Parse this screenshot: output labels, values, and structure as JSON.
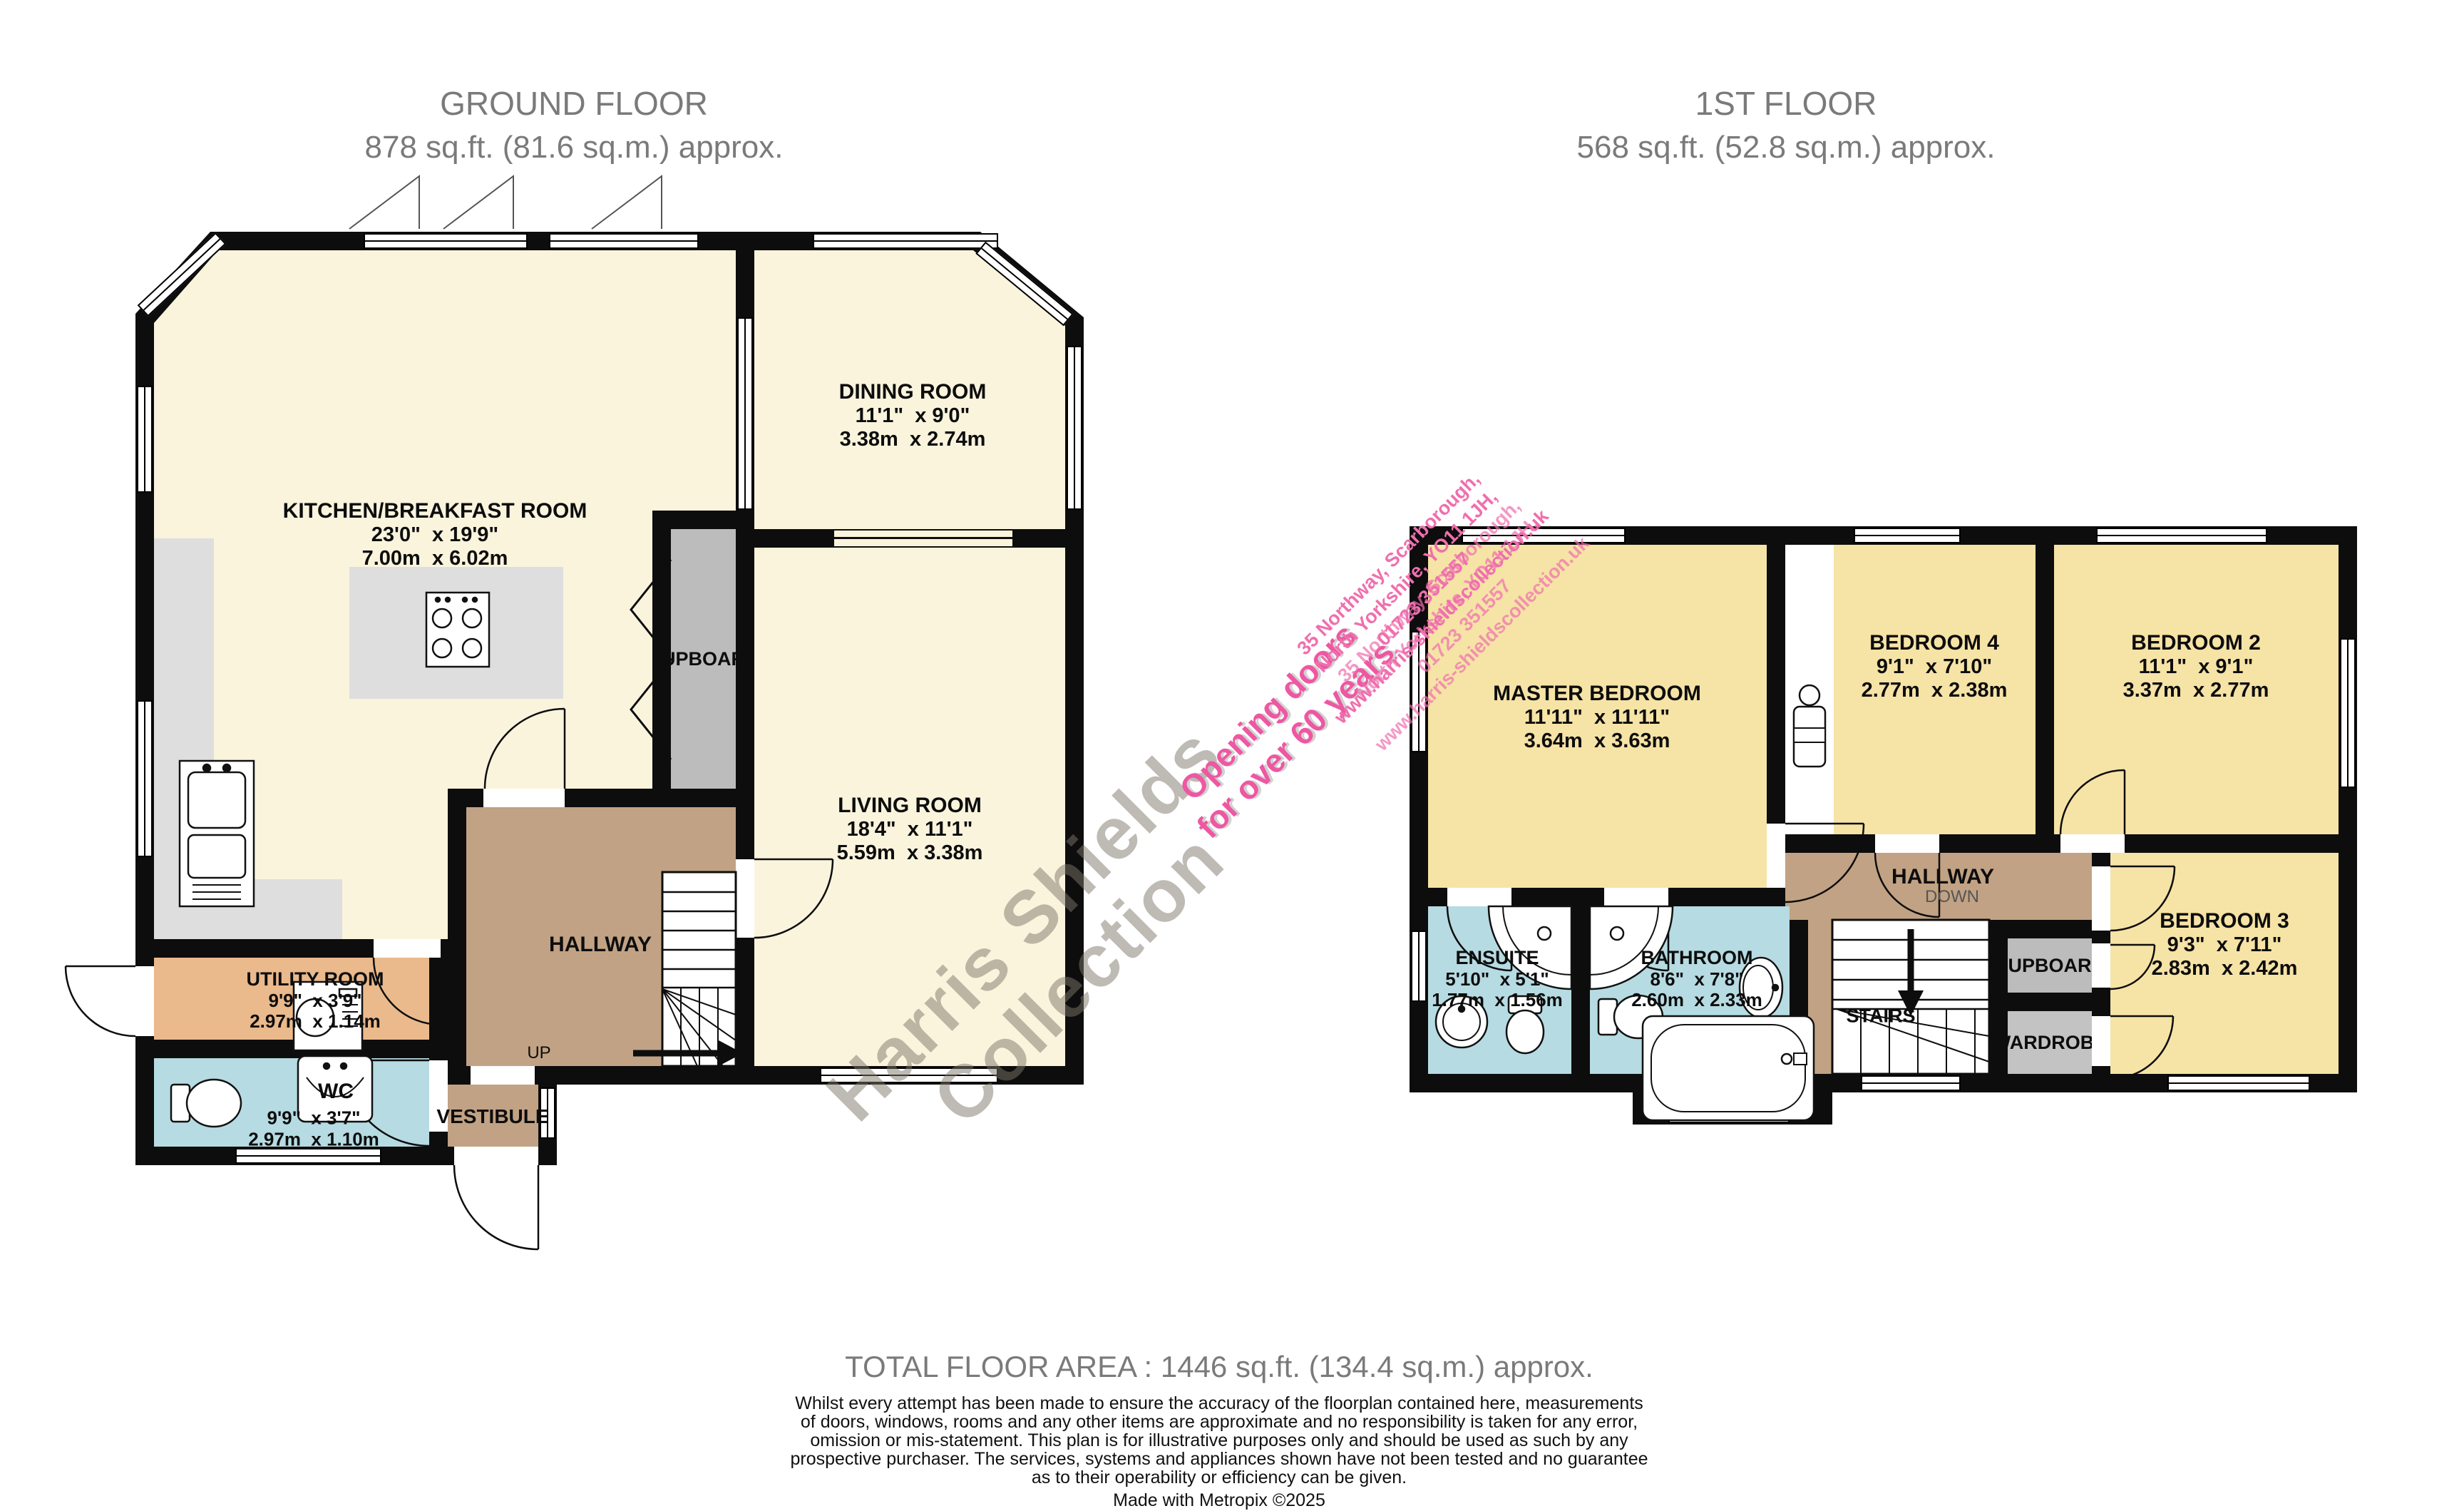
{
  "titles": {
    "ground": {
      "line1": "GROUND FLOOR",
      "line2": "878 sq.ft. (81.6 sq.m.) approx."
    },
    "first": {
      "line1": "1ST FLOOR",
      "line2": "568 sq.ft. (52.8 sq.m.) approx."
    }
  },
  "ground_floor": {
    "kitchen": {
      "name": "KITCHEN/BREAKFAST ROOM",
      "imperial": "23'0\"  x 19'9\"",
      "metric": "7.00m  x 6.02m"
    },
    "dining": {
      "name": "DINING ROOM",
      "imperial": "11'1\"  x 9'0\"",
      "metric": "3.38m  x 2.74m"
    },
    "living": {
      "name": "LIVING ROOM",
      "imperial": "18'4\"  x 11'1\"",
      "metric": "5.59m  x 3.38m"
    },
    "utility": {
      "name": "UTILITY ROOM",
      "imperial": "9'9\"  x 3'9\"",
      "metric": "2.97m  x 1.14m"
    },
    "wc": {
      "name": "WC",
      "imperial": "9'9\"  x 3'7\"",
      "metric": "2.97m  x 1.10m"
    },
    "cupboard_label": "CUPBOARD",
    "hallway_label": "HALLWAY",
    "vestibule_label": "VESTIBULE",
    "up_label": "UP"
  },
  "first_floor": {
    "master": {
      "name": "MASTER BEDROOM",
      "imperial": "11'11\"  x 11'11\"",
      "metric": "3.64m  x 3.63m"
    },
    "bedroom4": {
      "name": "BEDROOM 4",
      "imperial": "9'1\"  x 7'10\"",
      "metric": "2.77m  x 2.38m"
    },
    "bedroom2": {
      "name": "BEDROOM 2",
      "imperial": "11'1\"  x 9'1\"",
      "metric": "3.37m  x 2.77m"
    },
    "bedroom3": {
      "name": "BEDROOM 3",
      "imperial": "9'3\"  x 7'11\"",
      "metric": "2.83m  x 2.42m"
    },
    "ensuite": {
      "name": "ENSUITE",
      "imperial": "5'10\"  x 5'1\"",
      "metric": "1.77m  x 1.56m"
    },
    "bathroom": {
      "name": "BATHROOM",
      "imperial": "8'6\"  x 7'8\"",
      "metric": "2.60m  x 2.33m"
    },
    "hallway_label": "HALLWAY",
    "down_label": "DOWN",
    "stairs_label": "STAIRS",
    "cupboard_label": "CUPBOARD",
    "wardrobe_label": "WARDROBE"
  },
  "watermarks": {
    "brand_line1": "Harris Shields",
    "brand_line2": "Collection",
    "slogan_line1": "Opening doors",
    "slogan_line2": "for over 60 years",
    "address_line1": "35 Northway, Scarborough,",
    "address_line2": "North Yorkshire, YO11 1JH,",
    "phone": "01723 351557",
    "website": "www.harris-shieldscollection.uk"
  },
  "footer": {
    "total": "TOTAL FLOOR AREA : 1446 sq.ft. (134.4 sq.m.) approx.",
    "disclaimer_line1": "Whilst every attempt has been made to ensure the accuracy of the floorplan contained here, measurements",
    "disclaimer_line2": "of doors, windows, rooms and any other items are approximate and no responsibility is taken for any error,",
    "disclaimer_line3": "omission or mis-statement. This plan is for illustrative purposes only and should be used as such by any",
    "disclaimer_line4": "prospective purchaser. The services, systems and appliances shown have not been tested and no guarantee",
    "disclaimer_line5": "as to their operability or efficiency can be given.",
    "credit": "Made with Metropix ©2025"
  },
  "colors": {
    "wall": "#0d0d0d",
    "ground_room": "#faf4dd",
    "first_room": "#f6e3a6",
    "hallway_tan": "#c1a284",
    "utility_orange": "#eab98c",
    "wet_blue": "#b6dbe2",
    "cupboard_gray": "#bcbcbc",
    "counter_gray": "#dedede",
    "title_gray": "#7a7a7a",
    "watermark_pink": "#ee57a2"
  }
}
